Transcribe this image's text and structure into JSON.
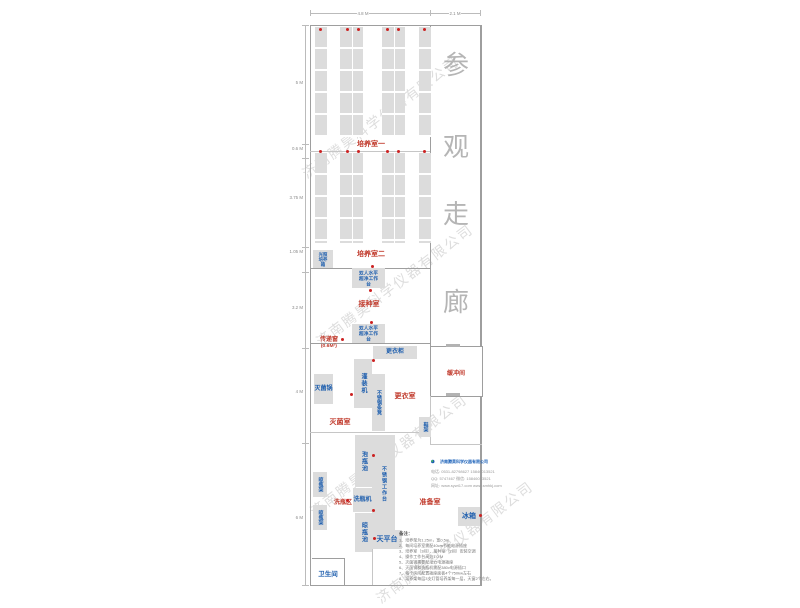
{
  "plan": {
    "dimensions": {
      "top": [
        "4.8 M",
        "2.1 M"
      ],
      "left": [
        "5 M",
        "0.6 M",
        "3.75 M",
        "1.05 M",
        "3.2 M",
        "4 M",
        "6 M"
      ]
    },
    "corridor": {
      "chars": [
        "参",
        "观",
        "走",
        "廊"
      ]
    },
    "rooms": {
      "culture1": "培养室一",
      "culture2": "培养室二",
      "inoculation": "接种室",
      "transfer_window": "传递窗",
      "transfer_window_size": "(0.6M²)",
      "changing": "更衣室",
      "sterilization": "灭菌室",
      "buffer": "缓冲间",
      "washing": "洗瓶区",
      "preparation": "准备室",
      "restroom": "卫生间"
    },
    "equipment": {
      "light_incubator_l1": "光照",
      "light_incubator_l2": "培养箱",
      "clean_bench_l1": "双人水平",
      "clean_bench_l2": "超净工作台",
      "wardrobe": "更衣柜",
      "filling_machine": "灌装机",
      "filling_table": "灌装台",
      "steel_bench": "不锈钢条凳",
      "autoclave": "灭菌锅",
      "shoe_rack": "鞋架",
      "soak_pool": "泡瓶池",
      "steel_worktable": "不锈钢工作台",
      "bottle_washer": "洗瓶机",
      "drying_pool": "晾瓶池",
      "balance_table": "天平台",
      "drying_rack": "晾瓶架",
      "fridge": "冰箱"
    },
    "watermark": "济南腾昊科学仪器有限公司",
    "company": {
      "name": "济南腾昊科学仪器有限公司",
      "tel": "电话: 0531-82798627  15846013521",
      "qq": "QQ: 5747467  微信: 15846013521",
      "web": "网址: www.sywt17.com  www.smhkj.com"
    },
    "notes": {
      "title": "备注：",
      "items": [
        "1、培养架为1.25m，宽0.5m",
        "2、每间培养室需配40cm节能电源插座",
        "3、培养室（3间）、接种室（2间）安装空调",
        "4、操作工作台高为1.0 M",
        "5、灭菌锅需要配动力电源插座",
        "6、灭菌锅和洗瓶机需配380v电源插口",
        "7、每个房间配置插座面板4个750kw左右",
        "8、培养架每层3支灯管培养架每一层，天窗2个左右。"
      ]
    }
  },
  "colors": {
    "label_red": "#c0392b",
    "label_blue": "#1f5fae",
    "corridor_text": "#b5b5b5",
    "rack_fill": "#dcdcdc",
    "wall": "#9e9e9e",
    "marker_dot": "#cc2222"
  }
}
